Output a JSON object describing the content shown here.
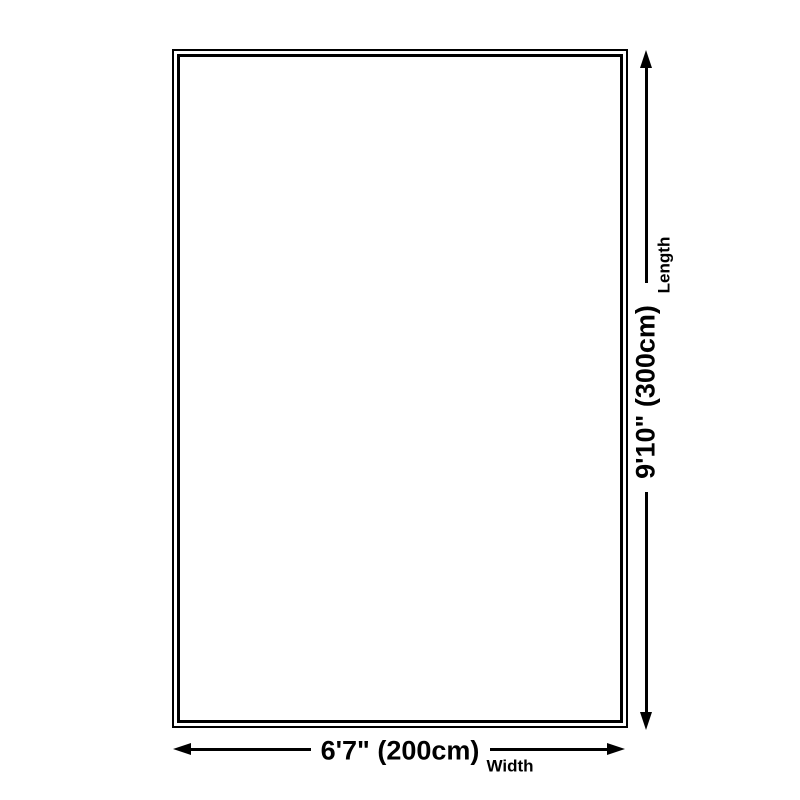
{
  "dimensions": {
    "width": {
      "value": "6'7\" (200cm)",
      "axis_label": "Width"
    },
    "length": {
      "value": "9'10\" (300cm)",
      "axis_label": "Length"
    }
  },
  "colors": {
    "line": "#000000",
    "background": "#ffffff"
  }
}
